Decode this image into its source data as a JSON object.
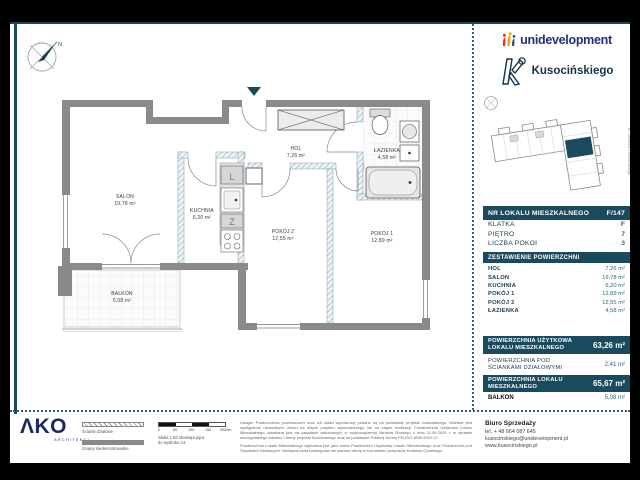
{
  "colors": {
    "teal": "#1a4a5e",
    "navy_brand": "#1f2f7a",
    "navy_project": "#14324a",
    "navy_architect": "#1c2a63",
    "wall_gray": "#8a8a8a",
    "brand_red": "#e63329",
    "brand_yellow": "#f5a200",
    "brand_blue": "#2850a0"
  },
  "brand": {
    "name": "unidevelopment"
  },
  "project": {
    "name": "Kusocińskiego"
  },
  "compass": {
    "north": "N"
  },
  "plan": {
    "rooms": [
      {
        "name": "SALON",
        "area": "19,78 m²"
      },
      {
        "name": "KUCHNIA",
        "area": "6,20 m²"
      },
      {
        "name": "HOL",
        "area": "7,26 m²"
      },
      {
        "name": "ŁAZIENKA",
        "area": "4,58 m²"
      },
      {
        "name": "POKÓJ 2",
        "area": "12,55 m²"
      },
      {
        "name": "POKÓJ 1",
        "area": "12,89 m²"
      },
      {
        "name": "BALKON",
        "area": "5,08 m²"
      }
    ],
    "appliances": {
      "fridge": "L",
      "dishwasher": "Z"
    }
  },
  "keyplan": {
    "street": "ul. Janusza Kusocińskiego"
  },
  "unit": {
    "number_label": "NR LOKALU MIESZKALNEGO",
    "number_value": "F/147",
    "rows": [
      {
        "label": "KLATKA",
        "value": "F"
      },
      {
        "label": "PIĘTRO",
        "value": "7"
      },
      {
        "label": "LICZBA POKOI",
        "value": "3"
      }
    ]
  },
  "areas": {
    "header": "ZESTAWIENIE POWIERZCHNI",
    "rows": [
      {
        "label": "HOL",
        "value": "7,26 m²"
      },
      {
        "label": "SALON",
        "value": "19,78 m²"
      },
      {
        "label": "KUCHNIA",
        "value": "6,20 m²"
      },
      {
        "label": "POKÓJ 1",
        "value": "12,89 m²"
      },
      {
        "label": "POKÓJ 2",
        "value": "12,55 m²"
      },
      {
        "label": "ŁAZIENKA",
        "value": "4,58 m²"
      }
    ]
  },
  "summary": {
    "usable_label": "POWIERZCHNIA UŻYTKOWA LOKALU MIESZKALNEGO",
    "usable_value": "63,26 m²",
    "partition_label": "POWIERZCHNIA POD ŚCIANKAMI DZIAŁOWYMI",
    "partition_value": "2,41 m²",
    "total_label": "POWIERZCHNIA LOKALU MIESZKALNEGO",
    "total_value": "65,67 m²",
    "balcony_label": "BALKON",
    "balcony_value": "5,08 m²"
  },
  "footer": {
    "architect": {
      "name": "ΛKO",
      "subtitle": "ARCHITEKCI"
    },
    "legend": {
      "partition": "Ścianki działowe",
      "structural": "Ściany niedemontowalne"
    },
    "scale": {
      "t0": "0",
      "t1": "50",
      "t2": "100",
      "t3": "150",
      "t4": "200cm",
      "caption1": "Skala 1:50 obowiązująca",
      "caption2": "do wydruku A3"
    },
    "disclaimer": [
      "Uwaga: Powierzchnia pomieszczeń oraz ich układ wymiarowy podane są na podstawie projektu budowlanego. Możliwe jest wystąpienie nieistotnych zmian na etapie projektu wykonawczego lub na etapie realizacji. Powierzchnia Użytkowa Lokalu Mieszkalnego określana jest na zasadach wskazanych w rozporządzeniu Ministra Rozwoju z dnia 11.09.2020 r. w sprawie szczegółowego zakresu i formy projektu budowlanego oraz na podstawie Polskiej Normy PN-ISO 9836:2022-07.",
      "Powierzchnia Lokalu Mieszkalnego wyliczana jest jako suma Powierzchni Użytkowej Lokalu Mieszkalnego oraz Powierzchni pod Ściankami Działowymi. Niniejsza karta katalogowa nie stanowi oferty w rozumieniu przepisów Kodeksu Cywilnego."
    ],
    "sales": {
      "title": "Biuro Sprzedaży",
      "phone": "tel. + 48 664 087 645",
      "email": "kusocinskiego@unidevelopment.pl",
      "web": "www.kusocinskiego.pl"
    }
  }
}
